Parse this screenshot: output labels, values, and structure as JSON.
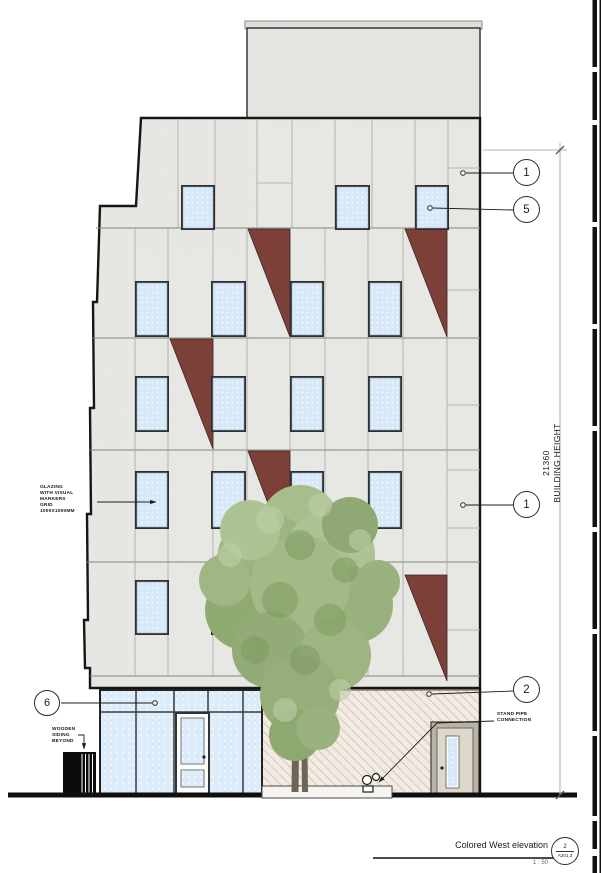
{
  "callouts": {
    "top_right_1": "1",
    "top_right_5": "5",
    "mid_right_1": "1",
    "bottom_right_2": "2",
    "bottom_left_6": "6"
  },
  "annotations": {
    "glazing_note": "GLAZING\nWITH VISUAL\nMARKERS\nGRID\n1000X1000MM",
    "wooden_note": "WOODEN\nSIDING\nBEYOND",
    "standpipe_note": "STAND PIPE\nCONNECTION"
  },
  "dimension": {
    "value": "21360",
    "label": "BUILDING HEIGHT"
  },
  "title_block": {
    "view_name": "Colored West elevation",
    "scale": "1 : 50",
    "detail_number": "2",
    "sheet_number": "A201.3"
  },
  "colors": {
    "facade": "#eaeae6",
    "accent_panel": "#7c4038",
    "glazing": "#d7e9f9",
    "foliage": "#9db77f",
    "hatch_wall": "#f2ebe4"
  }
}
